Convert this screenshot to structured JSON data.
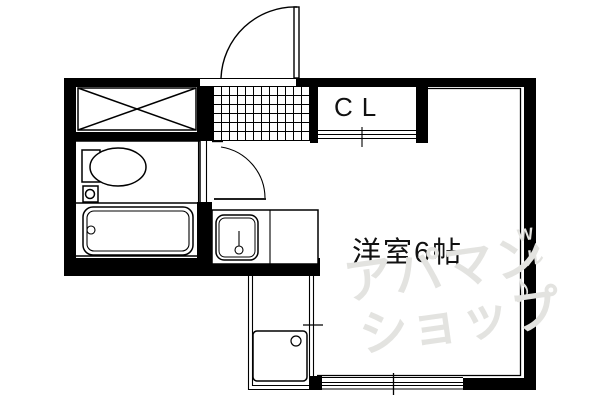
{
  "labels": {
    "closet": "CL",
    "main_room": "洋室6帖"
  },
  "watermark": {
    "line1": "アパマン",
    "line2": "ショップ",
    "mark_w": "W",
    "mark_ru": "ル",
    "mark_note": "♪",
    "color": "#e3e3e0"
  },
  "colors": {
    "line": "#000000",
    "background": "#ffffff"
  },
  "fixtures": [
    "entrance-door",
    "genkan-tile-floor",
    "crossed-storage-box",
    "closet",
    "toilet",
    "bathtub",
    "kitchen-sink-counter",
    "interior-door",
    "washing-machine-space",
    "sliding-window",
    "closet-sliding-door"
  ]
}
